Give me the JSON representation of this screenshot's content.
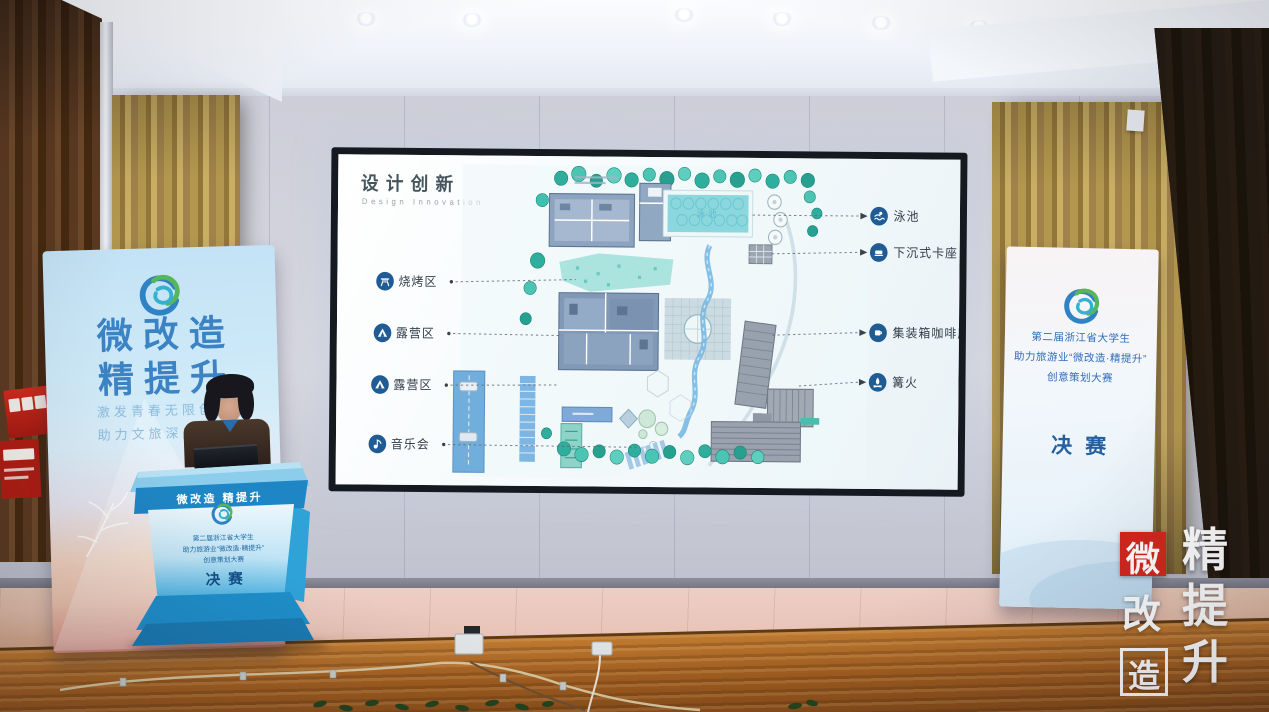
{
  "slide": {
    "title": "设计创新",
    "subtitle": "Design Innovation",
    "plan": {
      "pool_label": "泳池"
    },
    "left_labels": [
      {
        "label": "烧烤区",
        "icon": "grill-icon"
      },
      {
        "label": "露营区",
        "icon": "tent-icon"
      },
      {
        "label": "露营区",
        "icon": "tent-icon"
      },
      {
        "label": "音乐会",
        "icon": "music-icon"
      }
    ],
    "right_labels": [
      {
        "label": "泳池",
        "icon": "swimmer-icon"
      },
      {
        "label": "下沉式卡座",
        "icon": "sofa-icon"
      },
      {
        "label": "集装箱咖啡厅",
        "icon": "coffee-icon"
      },
      {
        "label": "篝火",
        "icon": "bonfire-icon"
      }
    ]
  },
  "left_banner": {
    "title_line1": "微改造",
    "title_line2": "精提升",
    "subtitle_line1": "激发青春无限创意",
    "subtitle_line2": "助力文旅深度融合"
  },
  "podium": {
    "band_label": "微改造 精提升",
    "line1": "第二届浙江省大学生",
    "line2": "助力旅游业“微改造·精提升”",
    "line3": "创意策划大赛",
    "final_label": "决赛"
  },
  "right_banner": {
    "line1": "第二届浙江省大学生",
    "line2": "助力旅游业“微改造·精提升”",
    "line3": "创意策划大赛",
    "final_label": "决赛"
  },
  "watermark": {
    "col1": [
      "微",
      "改",
      "造"
    ],
    "col2": [
      "精",
      "提",
      "升"
    ]
  },
  "colors": {
    "podium_blue": "#2aa3dd",
    "banner_title_blue": "#3c83c4",
    "label_icon_blue": "#1f5c95",
    "watermark_red": "#d3271c",
    "plan_teal": "#3fbfae",
    "curtain_gold": "#b3974e"
  }
}
